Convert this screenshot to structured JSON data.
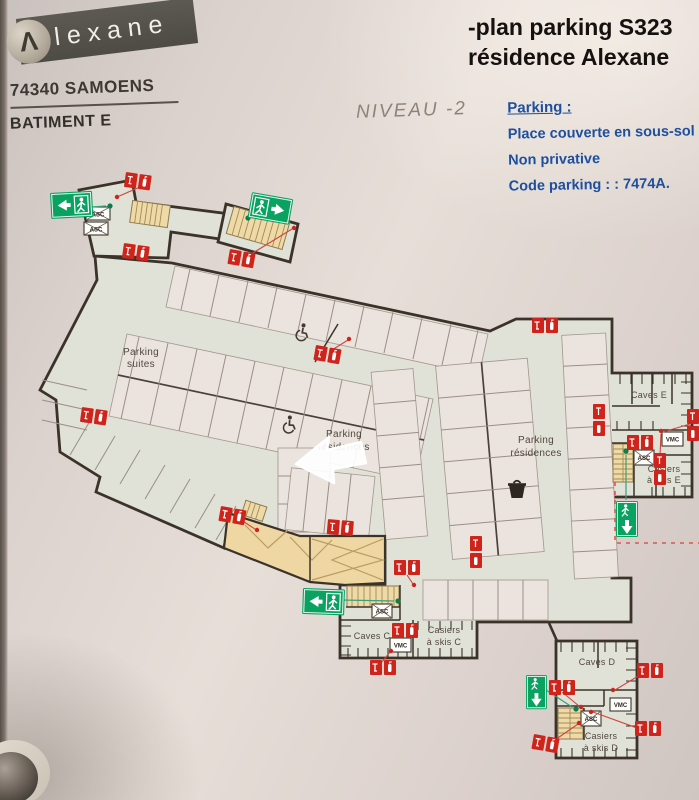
{
  "header": {
    "brand": "lexane",
    "brand_mark": "Λ",
    "postal_city": "74340 SAMOENS",
    "building": "BATIMENT E"
  },
  "title": {
    "line1": "-plan parking S323",
    "line2": "résidence Alexane"
  },
  "level_label": "NIVEAU -2",
  "parking_note": {
    "heading": "Parking :",
    "lines": [
      "Place couverte en sous-sol",
      "Non privative",
      "Code parking : : 7474A."
    ]
  },
  "plan_labels": {
    "parking_suites": [
      "Parking",
      "suites"
    ],
    "parking_residences_left": [
      "Parking",
      "résidences"
    ],
    "parking_residences_right": [
      "Parking",
      "résidences"
    ],
    "caves_e": "Caves E",
    "casiers_e": [
      "Casiers",
      "à skis E"
    ],
    "caves_c": "Caves C",
    "casiers_c": [
      "Casiers",
      "à skis C"
    ],
    "caves_d": "Caves D",
    "casiers_d": [
      "Casiers",
      "à skis D"
    ],
    "asc": "ASC",
    "vmc": "VMC"
  },
  "icons": {
    "exit": "emergency-exit-running-man",
    "fire": "fire-extinguisher-call-point",
    "accessible": "wheelchair-accessible-spot",
    "bin": "trash-bin",
    "target": "white-location-arrow"
  },
  "colors": {
    "safety_red": "#cf241b",
    "exit_green": "#0aa261",
    "note_blue": "#1d4f9e",
    "wall": "#3b332a",
    "floor": "#e0e1d7",
    "stairs_tan": "#efdaa7"
  }
}
